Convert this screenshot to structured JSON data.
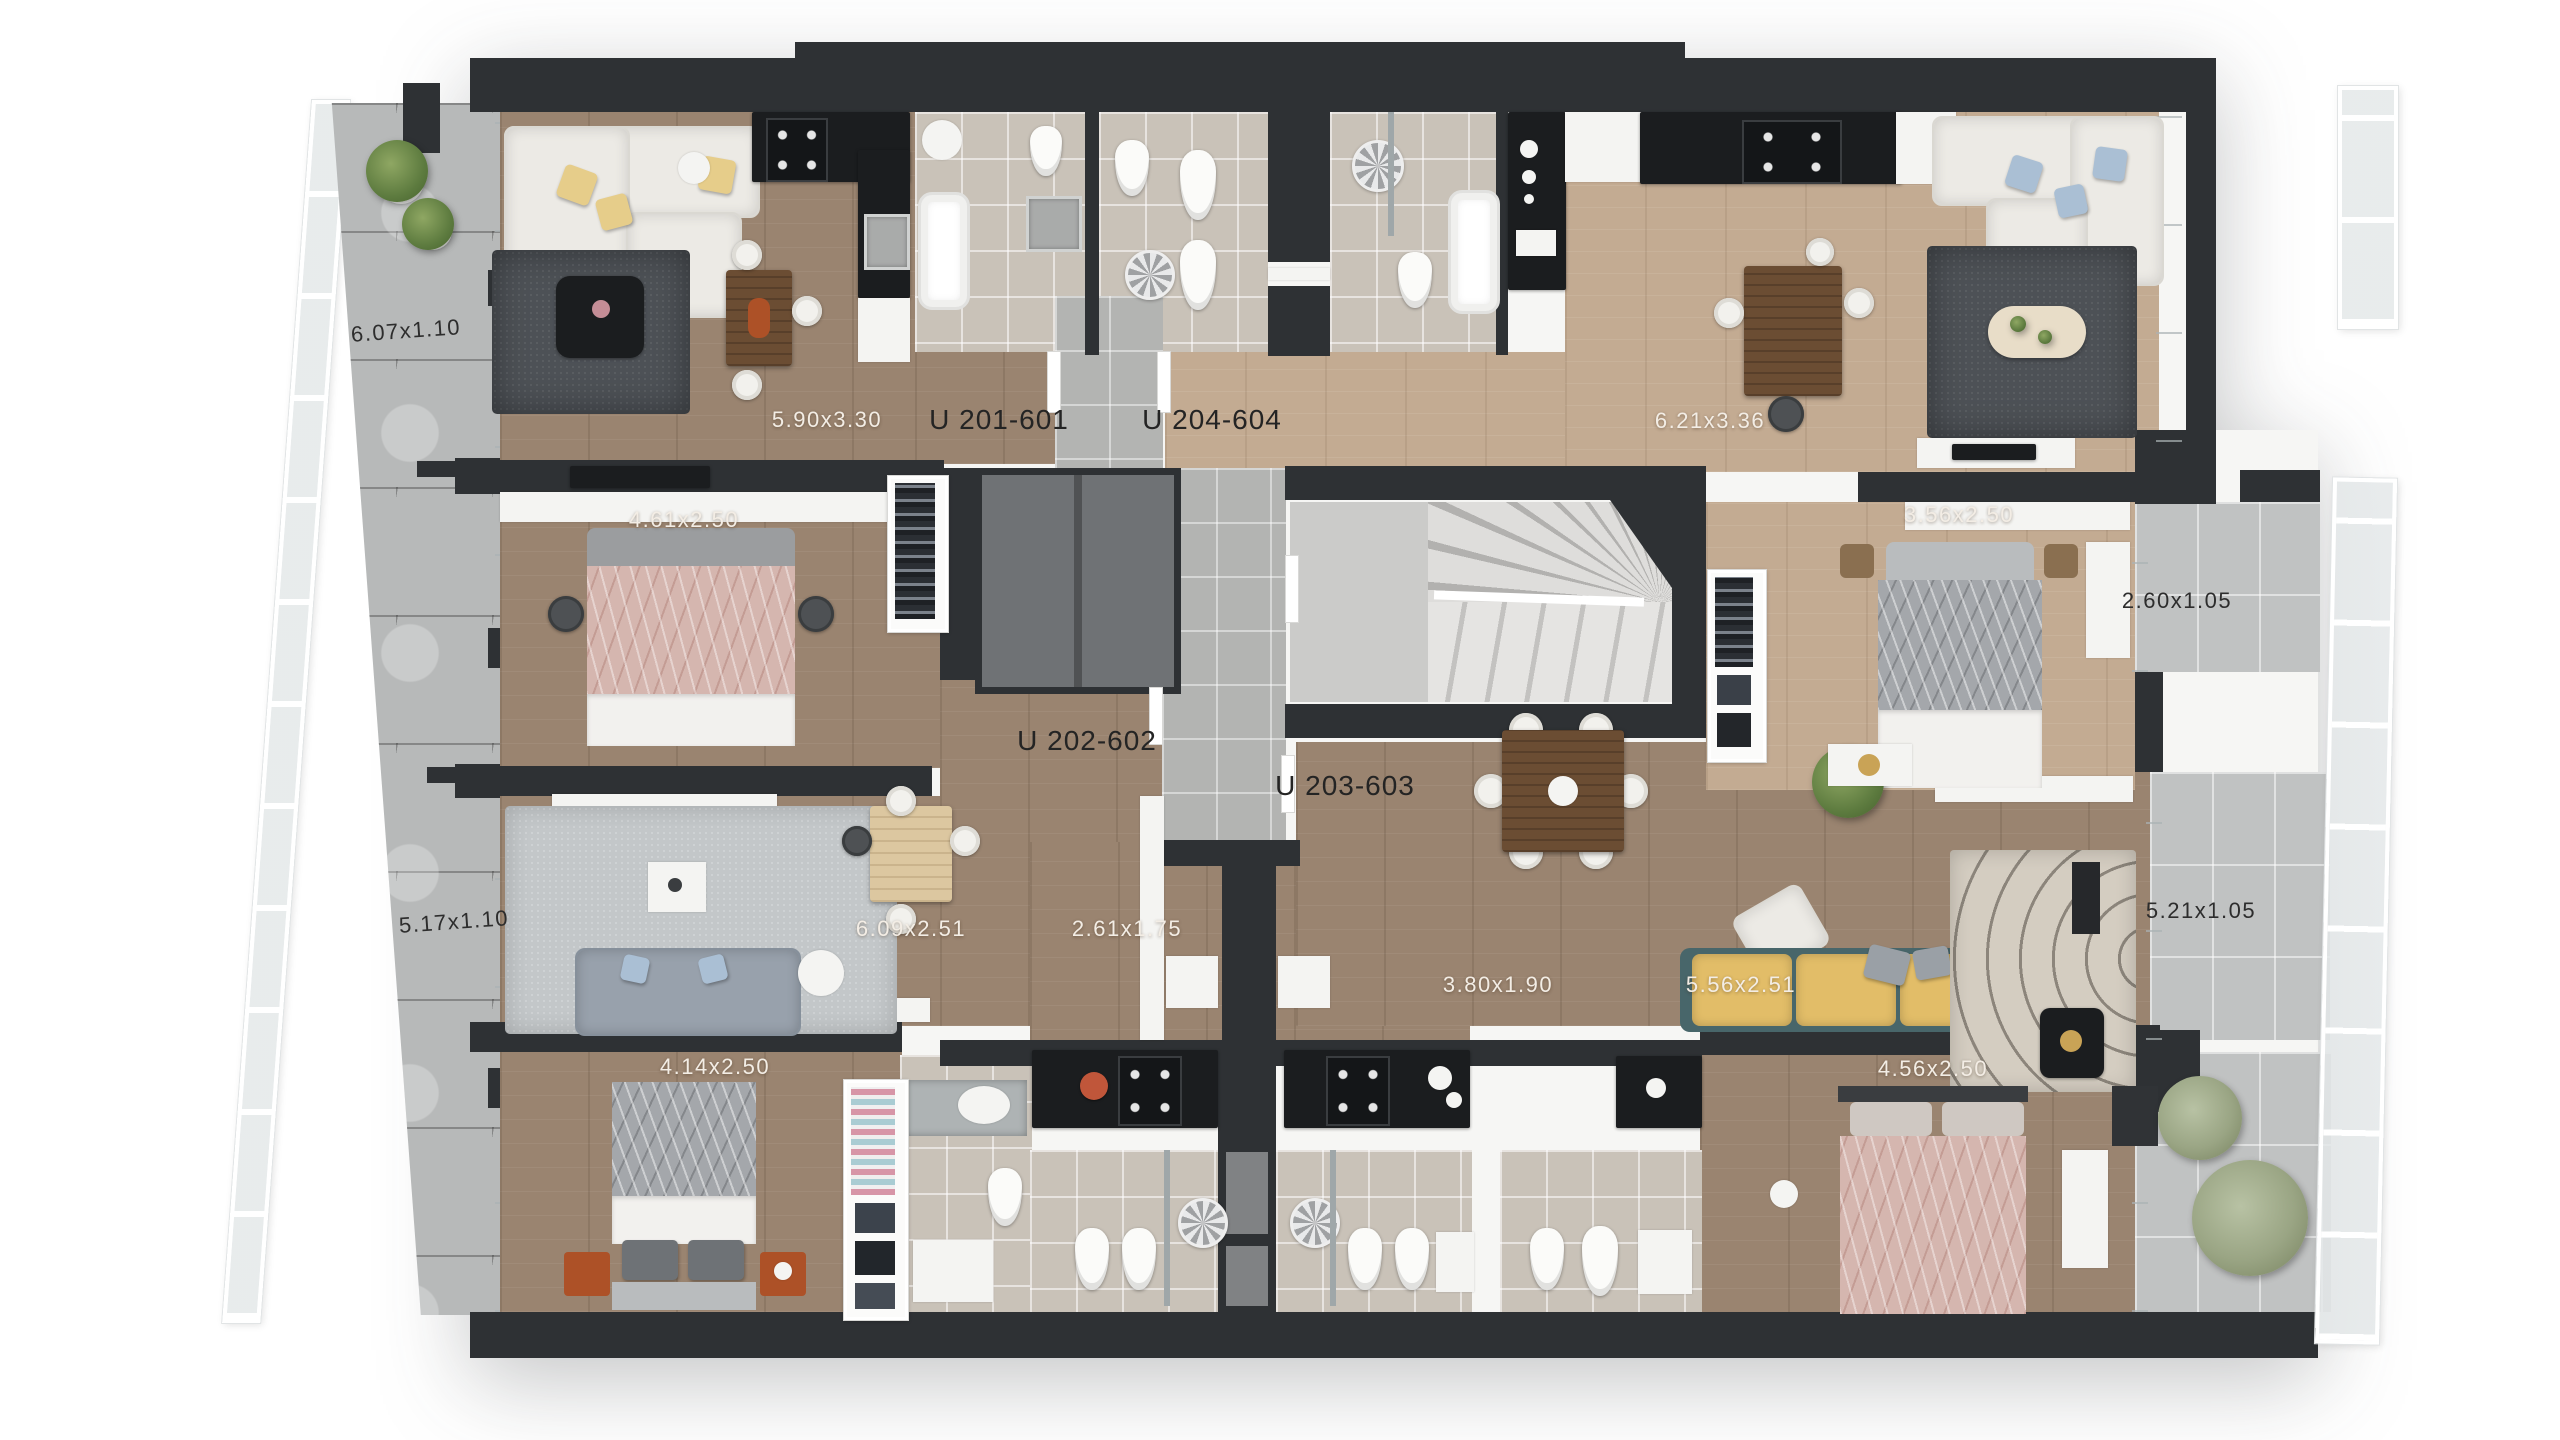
{
  "scene": {
    "type": "apartment-building floor plan, top-down 3d render",
    "background": "#ffffff"
  },
  "units": [
    {
      "id": "U 201-601",
      "rooms": {
        "living": "5.90x3.30",
        "bedroom": "4.61x2.50"
      }
    },
    {
      "id": "U 202-602",
      "rooms": {
        "living": "6.09x2.51",
        "kitchen": "2.61x1.75",
        "bedroom": "4.14x2.50"
      }
    },
    {
      "id": "U 203-603",
      "rooms": {
        "kitchen": "3.80x1.90",
        "living": "5.56x2.51",
        "bedroom": "4.56x2.50"
      }
    },
    {
      "id": "U 204-604",
      "rooms": {
        "living": "6.21x3.36",
        "bedroom": "3.56x2.50"
      }
    }
  ],
  "outdoor": [
    {
      "id": "terrace-upper-left",
      "dims": "6.07x1.10"
    },
    {
      "id": "terrace-lower-left",
      "dims": "5.17x1.10"
    },
    {
      "id": "balcony-upper-right",
      "dims": "2.60x1.05"
    },
    {
      "id": "balcony-right",
      "dims": "5.21x1.05"
    }
  ],
  "colors": {
    "wall": "#2e3134",
    "wood_dark": "#9a8470",
    "wood_light": "#c3ab92",
    "tile_bath": "#c9c2b8",
    "tile_corridor": "#b3b4b2",
    "concrete": "#b7b9b9",
    "rug_dark": "#4d5156",
    "rug_light": "#c3c7c9",
    "rug_beige": "#d4cdc1",
    "sofa_white": "#eceae5",
    "sofa_gray": "#98a1ac",
    "sofa_yellow": "#e2bd68",
    "bed_pink": "#d5b6af",
    "bed_gray": "#a4a7ab",
    "counter_black": "#1b1d1f",
    "accent_orange": "#ad5127",
    "plant_green": "#77894f",
    "plant_olive": "#9aa584"
  }
}
